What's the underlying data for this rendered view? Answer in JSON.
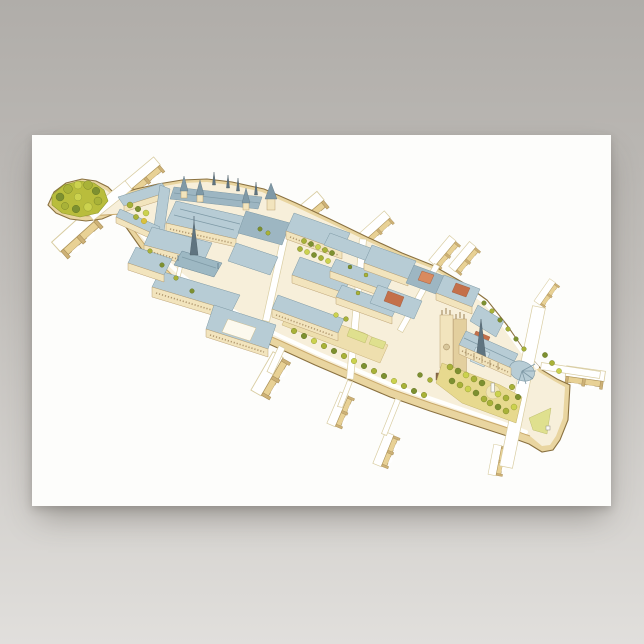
{
  "poster": {
    "label": "Ile de la Cite Paris aerial watercolor illustration poster"
  },
  "illustration": {
    "landmarks": [
      "vert-galant-square",
      "pont-neuf",
      "place-dauphine",
      "conciergerie",
      "sainte-chapelle",
      "palais-de-justice",
      "flower-market-trees",
      "hotel-dieu",
      "notre-dame-cathedral",
      "parvis-notre-dame",
      "square-jean-xxiii",
      "island-east-tip",
      "seine-bridges"
    ]
  },
  "colors": {
    "background_top": "#b0ada9",
    "background_bottom": "#e1dfdc",
    "poster_white": "#fdfdfb",
    "island_ground": "#f7efda",
    "quay_tan": "#e9d5a0",
    "quay_edge": "#8a7140",
    "wall_cream": "#f2e4bd",
    "wall_shade": "#e3cf9e",
    "roof_blue": "#b7ccd5",
    "roof_blue_dark": "#9db6c2",
    "roof_blue_light": "#cfe0e6",
    "roof_steep": "#9db8c3",
    "roof_red": "#c4704a",
    "roof_orange": "#d98a5f",
    "spire_slate": "#5f7480",
    "window_brown": "#9b7f55",
    "tree_green": "#a9b238",
    "tree_dark": "#7d9030",
    "tree_light": "#ccd24e",
    "lawn": "#dfe08e",
    "plaza_sand": "#eedfae",
    "garden_sand": "#e7d98e",
    "road_edge": "#d9cda2"
  }
}
